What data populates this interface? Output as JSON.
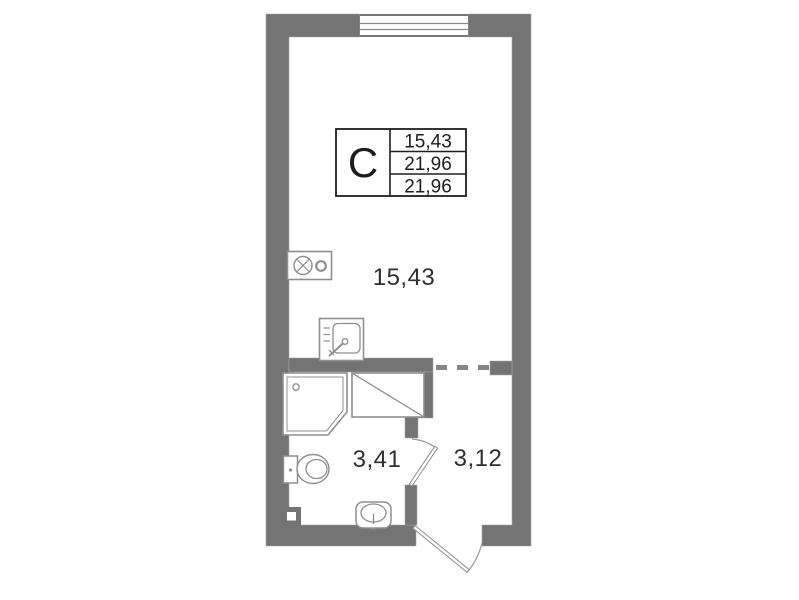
{
  "title": "Studio apartment floor plan",
  "info_table": {
    "type_letter": "С",
    "values": [
      "15,43",
      "21,96",
      "21,96"
    ]
  },
  "rooms": {
    "living": {
      "name": "living-room",
      "area": "15,43"
    },
    "bathroom": {
      "name": "bathroom",
      "area": "3,41"
    },
    "hallway": {
      "name": "hallway",
      "area": "3,12"
    }
  },
  "fixtures": [
    "window",
    "stove",
    "kitchen-sink",
    "shower-cabin",
    "ventilation-shaft",
    "toilet",
    "washbasin",
    "bathroom-door",
    "entrance-door",
    "opening-dashed-line"
  ],
  "colors": {
    "wall": "#747474",
    "fixture_stroke": "#8f8f8f",
    "door_stroke": "#9a9a9a",
    "dash": "#858585",
    "table_border": "#1f1f1f",
    "text": "#2f2f2f",
    "background": "#ffffff"
  }
}
